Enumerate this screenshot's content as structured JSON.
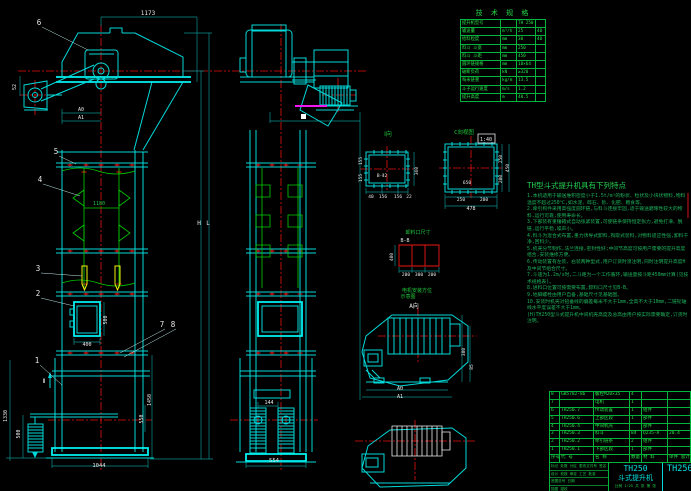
{
  "colors": {
    "cyan": "#00d9d9",
    "green": "#00d200",
    "red": "#f01414",
    "yellow": "#f2f20c",
    "magenta": "#f018f0",
    "white": "#ededed",
    "teal": "#0e8f8f",
    "table_green": "#00b43c"
  },
  "spec_table": {
    "title": "技 术 规 格",
    "col_widths": [
      38,
      14,
      17,
      17
    ],
    "rows": [
      [
        "提升机型号",
        "",
        "TH 250",
        ""
      ],
      [
        "输送量",
        "m³/h",
        "25",
        "40"
      ],
      [
        "给料粒度",
        "mm",
        "30",
        "40"
      ],
      [
        "料斗 斗宽",
        "mm",
        "250",
        ""
      ],
      [
        "料斗 斗距",
        "mm",
        "450",
        ""
      ],
      [
        "圆环链规格",
        "mm",
        "18×64",
        ""
      ],
      [
        "破断负荷",
        "kN",
        "≥320",
        ""
      ],
      [
        "每米链重",
        "kg/m",
        "13.5",
        ""
      ],
      [
        "斗子运行速度",
        "m/s",
        "1.2",
        ""
      ],
      [
        "提升高度",
        "m",
        "40.5",
        ""
      ]
    ]
  },
  "notes": {
    "title": "TH型斗式提升机具有下列特点",
    "lines": [
      "1.本机适用于输送堆积密度小于1.5t/m³的粉状、粒状及小块状物料,物料温度不超过250℃,如水泥、碎石、砂、化肥、粮食等。",
      "2.牵引构件采用高强度圆环链,与料斗连接牢固,适于输送磨琢性较大的物料,运行可靠,使用寿命长。",
      "3.下部装有重锤箱式自动张紧装置,可使链条保持恒定张力,避免打滑、脱链,运行平稳,噪声小。",
      "4.料斗为混合式布置,重力诱导式卸料,掏取式装料,对物料适应性强,卸料干净,回料少。",
      "5.机壳分节制作,法兰连接,密封性好;中间节高度可按用户需要的提升高度组合,安装维修方便。",
      "6.传动装置有左装、右装两种型式,用户订货时须注明,同时注明提升高度H及中间节组合尺寸。",
      "7.斗速为1.2m/s时,二斗距为一个工作循环,输送量按斗距450mm计算(见技术规格表)。",
      "8.进料口位置可按需要布置,卸料口尺寸见B-B。",
      "9.地脚螺栓由用户自备,基础尺寸见基础图。",
      "10.安装时机壳对铅垂线的偏差每米不大于1mm,全高不大于10mm,二链轮轴线水平度误差不大于1mm。",
      "(H)TH250型斗式提升机中间机壳高度及总高由用户按实际需要确定,订货时注明。"
    ]
  },
  "bom": {
    "col_widths": [
      8,
      32,
      34,
      10,
      24,
      34
    ],
    "rows": [
      [
        "8",
        "GB5782-86",
        "螺栓M20×35",
        "4",
        "",
        ""
      ],
      [
        "7",
        "",
        "电机",
        "1",
        "",
        ""
      ],
      [
        "6",
        "TH250.7",
        "传动装置",
        "1",
        "组件",
        ""
      ],
      [
        "5",
        "TH250.6",
        "上部区段",
        "1",
        "部件",
        ""
      ],
      [
        "4",
        "TH250.4",
        "中间机壳",
        "",
        "部件",
        ""
      ],
      [
        "3",
        "TH250.3",
        "料斗",
        "84",
        "Q235-A",
        "20.4"
      ],
      [
        "2",
        "TH250.2",
        "牵引链条",
        "2",
        "组件",
        ""
      ],
      [
        "1",
        "TH250.1",
        "下部区段",
        "1",
        "部件",
        ""
      ],
      [
        "序号",
        "代  号",
        "名  称",
        "数量",
        "材  料",
        "单件 总计"
      ]
    ]
  },
  "title_block": {
    "model": "TH250",
    "product": "斗式提升机",
    "drawing_no": "TH250",
    "scale_row": "比例 1:25  共 张 第 张",
    "left_rows": [
      "标记 处数 分区 更改文件号 签名 日期",
      "设计  校核  审定  工艺  批准",
      "底图总号        日期",
      "描图     描校"
    ]
  },
  "annotations": [
    {
      "t": "1173",
      "x": 148,
      "y": 15,
      "s": 6
    },
    {
      "t": "A0",
      "x": 81,
      "y": 111,
      "s": 5
    },
    {
      "t": "A1",
      "x": 81,
      "y": 119,
      "s": 5
    },
    {
      "t": "52",
      "x": 16,
      "y": 87,
      "s": 5,
      "r": -90
    },
    {
      "t": "1180",
      "x": 99,
      "y": 205,
      "s": 5,
      "c": "fg"
    },
    {
      "t": "400",
      "x": 87,
      "y": 346,
      "s": 5
    },
    {
      "t": "500",
      "x": 107,
      "y": 320,
      "s": 5,
      "r": -90
    },
    {
      "t": "1330",
      "x": 7,
      "y": 416,
      "s": 5,
      "r": -90
    },
    {
      "t": "500",
      "x": 20,
      "y": 434,
      "s": 5,
      "r": -90
    },
    {
      "t": "1450",
      "x": 151,
      "y": 400,
      "s": 5,
      "r": -90
    },
    {
      "t": "550",
      "x": 143,
      "y": 419,
      "s": 5,
      "r": -90
    },
    {
      "t": "1044",
      "x": 99,
      "y": 467,
      "s": 5.5
    },
    {
      "t": "H",
      "x": 199,
      "y": 225,
      "s": 6
    },
    {
      "t": "L",
      "x": 208,
      "y": 225,
      "s": 6
    },
    {
      "t": "554",
      "x": 274,
      "y": 462,
      "s": 5.5
    },
    {
      "t": "144",
      "x": 269,
      "y": 404,
      "s": 5
    },
    {
      "t": "Ⅱ",
      "x": 44,
      "y": 383,
      "s": 6
    },
    {
      "t": "Ⅰ向",
      "x": 388,
      "y": 136,
      "s": 6,
      "c": "fg"
    },
    {
      "t": "360",
      "x": 418,
      "y": 171,
      "s": 4.5,
      "r": -90
    },
    {
      "t": "155",
      "x": 362,
      "y": 161,
      "s": 4.5,
      "r": -90
    },
    {
      "t": "155",
      "x": 362,
      "y": 178,
      "s": 4.5,
      "r": -90
    },
    {
      "t": "40",
      "x": 371,
      "y": 198,
      "s": 4.5
    },
    {
      "t": "156",
      "x": 383,
      "y": 198,
      "s": 4.5
    },
    {
      "t": "156",
      "x": 398,
      "y": 198,
      "s": 4.5
    },
    {
      "t": "22",
      "x": 409,
      "y": 198,
      "s": 4.5
    },
    {
      "t": "B-Ⅱ2",
      "x": 382,
      "y": 177,
      "s": 4.5
    },
    {
      "t": "C向视图",
      "x": 464,
      "y": 134,
      "s": 5.5,
      "c": "fg"
    },
    {
      "t": "1:40",
      "x": 486,
      "y": 141,
      "s": 5
    },
    {
      "t": "250",
      "x": 502,
      "y": 159,
      "s": 4.5,
      "r": -90
    },
    {
      "t": "200",
      "x": 502,
      "y": 179,
      "s": 4.5,
      "r": -90
    },
    {
      "t": "450",
      "x": 509,
      "y": 168,
      "s": 4.5,
      "r": -90
    },
    {
      "t": "250",
      "x": 461,
      "y": 201,
      "s": 4.5
    },
    {
      "t": "200",
      "x": 484,
      "y": 201,
      "s": 4.5
    },
    {
      "t": "478",
      "x": 471,
      "y": 210,
      "s": 5
    },
    {
      "t": "650",
      "x": 467,
      "y": 184,
      "s": 4.5
    },
    {
      "t": "卸料口尺寸",
      "x": 418,
      "y": 234,
      "s": 5,
      "c": "fg"
    },
    {
      "t": "B-B",
      "x": 405,
      "y": 242,
      "s": 5
    },
    {
      "t": "400",
      "x": 393,
      "y": 257,
      "s": 4.5,
      "r": -90
    },
    {
      "t": "200",
      "x": 406,
      "y": 276,
      "s": 4.5
    },
    {
      "t": "300",
      "x": 419,
      "y": 276,
      "s": 4.5
    },
    {
      "t": "200",
      "x": 432,
      "y": 276,
      "s": 4.5
    },
    {
      "t": "电机安装方位",
      "x": 417,
      "y": 292,
      "s": 5,
      "c": "fg"
    },
    {
      "t": "示意图",
      "x": 408,
      "y": 298,
      "s": 5,
      "c": "fg"
    },
    {
      "t": "A向",
      "x": 414,
      "y": 308,
      "s": 6
    },
    {
      "t": "A0",
      "x": 400,
      "y": 390,
      "s": 5
    },
    {
      "t": "A1",
      "x": 400,
      "y": 398,
      "s": 5
    },
    {
      "t": "380",
      "x": 465,
      "y": 352,
      "s": 4.5,
      "r": -90
    },
    {
      "t": "85",
      "x": 473,
      "y": 367,
      "s": 4.5,
      "r": -90
    }
  ],
  "balloons": [
    {
      "n": "6",
      "x": 39,
      "y": 25,
      "lx": 88,
      "ly": 50
    },
    {
      "n": "5",
      "x": 56,
      "y": 154,
      "lx": 76,
      "ly": 164
    },
    {
      "n": "4",
      "x": 40,
      "y": 182,
      "lx": 80,
      "ly": 196
    },
    {
      "n": "3",
      "x": 38,
      "y": 271,
      "lx": 82,
      "ly": 276
    },
    {
      "n": "2",
      "x": 38,
      "y": 296,
      "lx": 74,
      "ly": 306
    },
    {
      "n": "1",
      "x": 37,
      "y": 363,
      "lx": 62,
      "ly": 385
    },
    {
      "n": "7",
      "x": 162,
      "y": 327,
      "lx": 120,
      "ly": 353
    },
    {
      "n": "8",
      "x": 173,
      "y": 327,
      "lx": 124,
      "ly": 357
    }
  ]
}
